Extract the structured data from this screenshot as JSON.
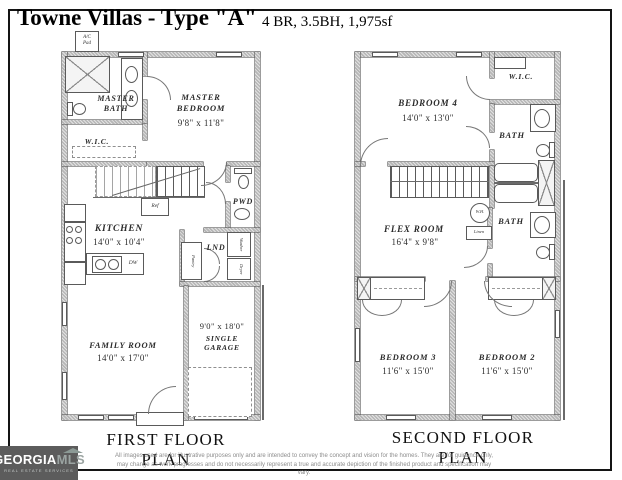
{
  "header": {
    "title": "Towne Villas - Type \"A\"",
    "specs": "4 BR, 3.5BH, 1,975sf"
  },
  "floor1": {
    "plan_label": "FIRST FLOOR PLAN",
    "ac_pad": "A/C\nPad",
    "master_bath": "MASTER\nBATH",
    "master_bedroom": "MASTER\nBEDROOM",
    "master_bedroom_dim": "9'8\" x 11'8\"",
    "wic": "W.I.C.",
    "pwd": "PWD",
    "kitchen": "KITCHEN",
    "kitchen_dim": "14'0\" x 10'4\"",
    "ref": "Ref",
    "dw": "DW",
    "lnd": "LND",
    "washer": "Washer",
    "dryer": "Dryer",
    "pantry": "Pantry",
    "family_room": "FAMILY ROOM",
    "family_room_dim": "14'0\" x 17'0\"",
    "garage_dim": "9'0\" x 18'0\"",
    "garage": "SINGLE\nGARAGE"
  },
  "floor2": {
    "plan_label": "SECOND FLOOR PLAN",
    "bedroom4": "BEDROOM 4",
    "bedroom4_dim": "14'0\" x 13'0\"",
    "wic": "W.I.C.",
    "bath_upper": "BATH",
    "bath_lower": "BATH",
    "wh": "W.H.",
    "linen": "Linen",
    "flex_room": "FLEX ROOM",
    "flex_room_dim": "16'4\" x 9'8\"",
    "bedroom3": "BEDROOM 3",
    "bedroom3_dim": "11'6\" x 15'0\"",
    "bedroom2": "BEDROOM 2",
    "bedroom2_dim": "11'6\" x 15'0\""
  },
  "footer": {
    "logo_primary": "GEORGIA",
    "logo_secondary": "MLS",
    "logo_tagline": "REAL ESTATE SERVICES",
    "disclaimer_line1": "All images used are for illustrative purposes only and are intended to convey the concept and vision for the homes. They are for guidance only,",
    "disclaimer_line2": "may change as work progresses and do not necessarily represent a true and accurate depiction of the finished product and specification may vary."
  },
  "colors": {
    "wall_fill": "#b6b6b6",
    "line": "#5a5a5a",
    "frame": "#141414",
    "logo_bg": "#5c5c5c",
    "logo_mls": "#9ba4a2",
    "disclaimer_text": "#8d8d8d"
  }
}
